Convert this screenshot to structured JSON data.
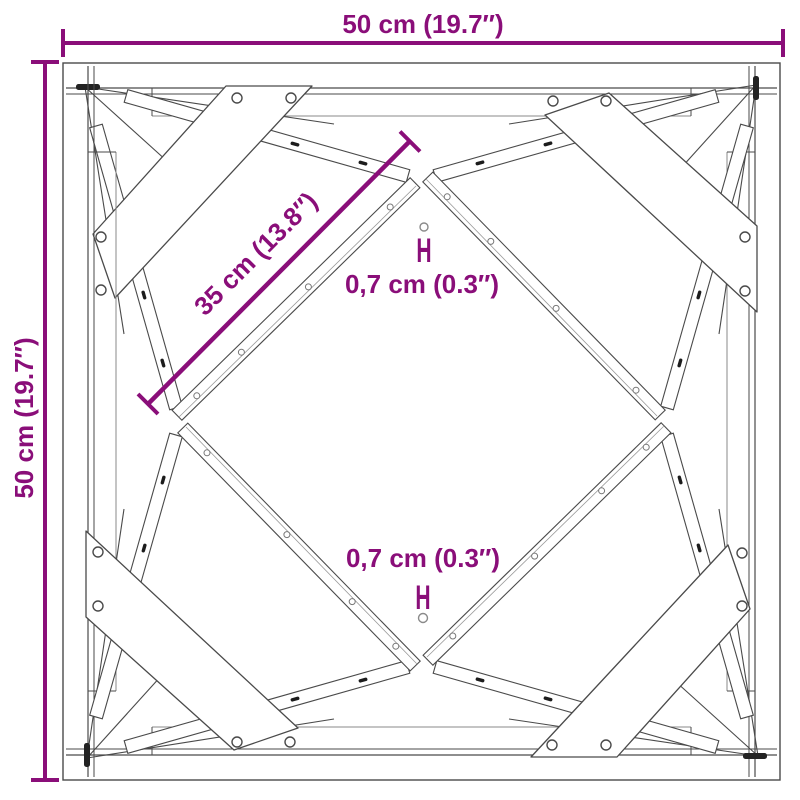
{
  "annotations": {
    "width": "50 cm (19.7″)",
    "height": "50 cm (19.7″)",
    "diagonal": "35 cm (13.8″)",
    "thickness_top": "0,7 cm (0.3″)",
    "thickness_bottom": "0,7 cm (0.3″)",
    "thickness_marker_top": "H",
    "thickness_marker_bottom": "H"
  },
  "colors": {
    "dimension": "#8A0E79",
    "line": "#4A4A4A",
    "line_light": "#909090",
    "hole_fill": "#1C1C1C",
    "background": "#FFFFFF"
  }
}
